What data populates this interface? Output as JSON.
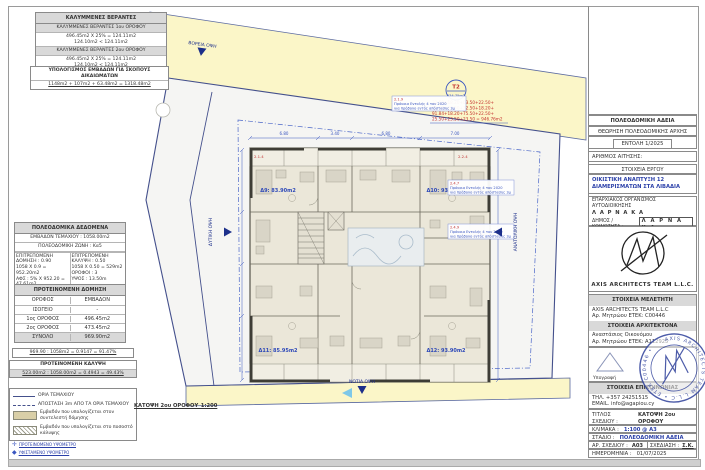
{
  "sheet": {
    "caption": "ΚΑΤΟΨΗ 2ου ΟΡΟΦΟΥ_1:200"
  },
  "left_panel": {
    "verandas": {
      "title": "ΚΑΛΥΜΜΕΝΕΣ ΒΕΡΑΝΤΕΣ",
      "rows": [
        {
          "header": "ΚΑΛΥΜΜΕΝΕΣ ΒΕΡΑΝΤΕΣ 1ου ΟΡΟΦΟΥ",
          "calc": "496.45m2 Χ 25% = 124.11m2",
          "check": "124.10m2 < 124.11m2"
        },
        {
          "header": "ΚΑΛΥΜΜΕΝΕΣ ΒΕΡΑΝΤΕΣ 2ου ΟΡΟΦΟΥ",
          "calc": "496.45m2 Χ 25% = 124.11m2",
          "check": "124.10m2 < 124.11m2"
        }
      ]
    },
    "rights": {
      "title": "ΥΠΟΛΟΓΙΣΜΟΣ ΕΜΒΑΔΩΝ ΓΙΑ ΣΚΟΠΟΥΣ ΔΙΚΑΙΩΜΑΤΩΝ",
      "formula": "1148m2 + 107m2 + 63.48m2 = 1318.48m2"
    },
    "planning": {
      "title": "ΠΟΛΕΟΔΟΜΙΚΑ ΔΕΔΟΜΕΝΑ",
      "area_row": "ΕΜΒΑΔΟΝ ΤΕΜΑΧΙΟΥ : 1058.00m2",
      "zone_row": "ΠΟΛΕΟΔΟΜΙΚΗ ΖΩΝΗ : Κα5",
      "left": [
        "ΕΠΙΤΡΕΠΟΜΕΝΗ ΔΟΜΗΣΗ : 0.90",
        "1058 Χ 0.9 = 952.20m2",
        "ΑΦΣ : 5% Χ 952.20 = 47.61m2",
        "ΣΥΝΟΛΟ : 47.61m2 + 952.20m2 = 999.81m2"
      ],
      "right": [
        "ΕΠΙΤΡΕΠΟΜΕΝΗ ΚΑΛΥΨΗ : 0.50",
        "1058 Χ 0.50 = 529m2",
        "ΟΡΟΦΟΙ : 3",
        "ΥΨΟΣ : 13.50m"
      ]
    },
    "proposed": {
      "title": "ΠΡΟΤΕΙΝΟΜΕΝΗ ΔΟΜΗΣΗ",
      "col_floor": "ΟΡΟΦΟΣ",
      "col_area": "ΕΜΒΑΔΟΝ",
      "rows": [
        [
          "ΙΣΟΓΕΙΟ",
          "-"
        ],
        [
          "1ος ΟΡΟΦΟΣ",
          "496.45m2"
        ],
        [
          "2ος ΟΡΟΦΟΣ",
          "473.45m2"
        ],
        [
          "ΣΥΝΟΛΟ",
          "969.90m2"
        ]
      ]
    },
    "ratio": "969.90 : 1058m2 = 0.9147 = 91.47%",
    "coverage": {
      "title": "ΠΡΟΤΕΙΝΟΜΕΝΗ ΚΑΛΥΨΗ",
      "formula": "523.00m2 : 1058.00m2 = 0.4943 = 49.43%"
    },
    "legend": {
      "boundary": "ΟΡΙΑ ΤΕΜΑΧΙΟΥ",
      "setback": "ΑΠΟΣΤΑΣΗ 3m ΑΠΟ ΤΑ ΟΡΙΑ ΤΕΜΑΧΙΟΥ",
      "density": "Εμβαδόν που υπολογίζεται στον συντελεστή δόμησης",
      "cover": "Εμβαδόν που υπολογίζεται στο ποσοστό κάλυψης"
    },
    "markers": [
      "ΠΡΟΤΕΙΝΟΜΕΝΟ ΥΨΟΜΕΤΡΟ",
      "ΥΦΙΣΤΑΜΕΝΟ ΥΨΟΜΕΤΡΟ"
    ]
  },
  "plan": {
    "north": "ΒΟΡΕΙΑ ΟΨΗ",
    "south": "ΝΟΤΙΑ ΟΨΗ",
    "east": "ΑΝΑΤΟΛΙΚΗ ΟΨΗ",
    "west": "ΔΥΤΙΚΗ ΟΨΗ",
    "plot_ref": "T2",
    "plot_area": "934.75m2",
    "calc": [
      "32.50+18.20+03.50+22.50+",
      "75.10+27.50+32.50+18.20+",
      "91.84+18.20+75.50+22.50+",
      "25.50+23.50+23.50 = 946.76m2"
    ],
    "apartments": [
      "Δ9: 83.90m2",
      "Δ10: 93.90m2",
      "Δ11: 85.95m2",
      "Δ12: 93.90m2"
    ],
    "dims": [
      "6.80",
      "3.40",
      "6.80",
      "7.00"
    ],
    "refs": [
      "2.1.4",
      "2.2.4"
    ],
    "notes": [
      {
        "code": "2.1.9",
        "l1": "Πρόνοια Εντολής 4 του 2020",
        "l2": "για πρόβολο εντός απόστασης 3μ"
      },
      {
        "code": "2.4.7",
        "l1": "Πρόνοια Εντολής 4 του 2020",
        "l2": "για πρόβολο εντός απόστασης 3μ"
      },
      {
        "code": "2.4.9",
        "l1": "Πρόνοια Εντολής 4 του 2020",
        "l2": "για πρόβολο εντός απόστασης 3μ"
      }
    ]
  },
  "title_block": {
    "permit_title": "ΠΟΛΕΟΔΟΜΙΚΗ ΑΔΕΙΑ",
    "authority_line": "ΘΕΩΡΗΣΗ ΠΟΛΕΟΔΟΜΙΚΗΣ ΑΡΧΗΣ",
    "order_no": "ΕΝΤΟΛΗ 1/2025",
    "application_no_label": "ΑΡΙΘΜΟΣ ΑΙΤΗΣΗΣ:",
    "project_header": "ΣΤΟΙΧΕΙΑ ΕΡΓΟΥ",
    "project_title": "ΟΙΚΙΣΤΙΚΗ ΑΝΑΠΤΥΞΗ 12 ΔΙΑΜΕΡΙΣΜΑΤΩΝ ΣΤΑ ΛΙΒΑΔΙΑ",
    "district_org": "ΕΠΑΡΧΙΑΚΟΣ ΟΡΓΑΝΙΣΜΟΣ ΑΥΤΟΔΙΟΙΚΗΣΗΣ",
    "district_name": "Λ Α Ρ Ν Α Κ Α",
    "municipality_label": "ΔΗΜΟΣ / ΚΟΙΝΟΤΗΤΑ :",
    "municipality_value": "Λ Α Ρ Ν Α Κ Α",
    "logo_text": "AXIS ARCHITECTS TEAM L.L.C.",
    "designer_header": "ΣΤΟΙΧΕΙΑ ΜΕΛΕΤΗΤΗ",
    "designer_name": "AXIS ARCHITECTS TEAM L.L.C",
    "designer_reg": "Αρ. Μητρώου ΕΤΕΚ: C00446",
    "architect_header": "ΣΤΟΙΧΕΙΑ ΑΡΧΙΤΕΚΤΟΝΑ",
    "architect_name": "Αναστάσιος Οικονόμου",
    "architect_reg": "Αρ. Μητρώου ΕΤΕΚ: Α112925",
    "signature_label": "Υπογραφή",
    "stamp_text": "AXIS ARCHITECTS TEAM L.L.C • ΕΤΕΚ C00446 •",
    "contact_header": "ΣΤΟΙΧΕΙΑ ΕΠΙΚΟΙΝΩΝΙΑΣ",
    "phone": "ΤΗΛ. +357 24251515",
    "email": "EMAIL. info@agapiou.cy",
    "drawing_title_label": "ΤΙΤΛΟΣ ΣΧΕΔΙΟΥ :",
    "drawing_title_value": "ΚΑΤΟΨΗ 2ου ΟΡΟΦΟΥ",
    "scale_label": "ΚΛΙΜΑΚΑ :",
    "scale_value": "1:100 @ A3",
    "stage_label": "ΣΤΑΔΙΟ :",
    "stage_value": "ΠΟΛΕΟΔΟΜΙΚΗ ΑΔΕΙΑ",
    "drawing_no_label": "ΑΡ. ΣΧΕΔΙΟΥ :",
    "drawing_no_value": "Α03",
    "drawn_label": "ΣΧΕΔΙΑΣΗ :",
    "drawn_value": "Σ.Κ.",
    "date_label": "ΗΜΕΡΟΜΗΝΙΑ :",
    "date_value": "01/07/2025"
  }
}
